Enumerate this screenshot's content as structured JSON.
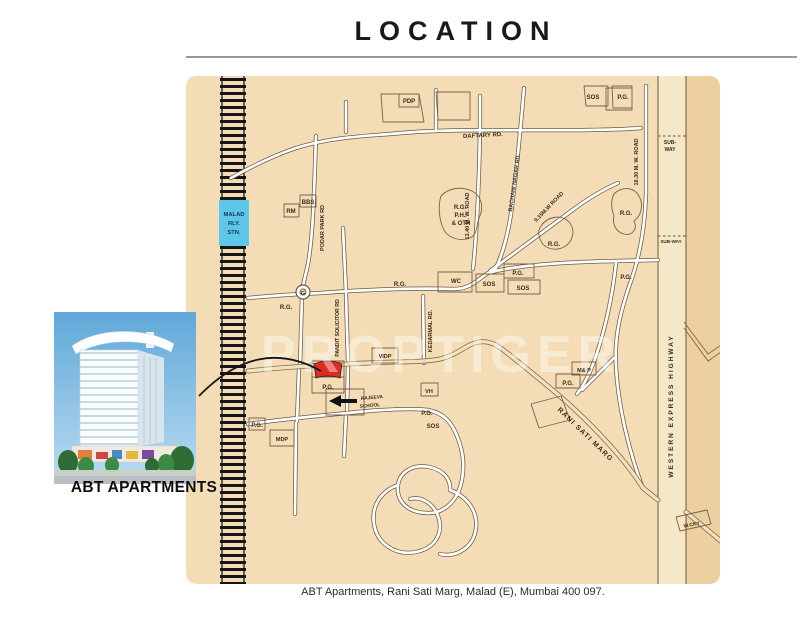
{
  "header": {
    "title": "LOCATION"
  },
  "footer": {
    "caption": "ABT Apartments, Rani Sati Marg, Malad (E), Mumbai 400 097."
  },
  "property": {
    "name": "ABT APARTMENTS"
  },
  "map": {
    "watermark": "PROPTIGER",
    "station": {
      "label": "MALAD RLY. STN."
    },
    "marker": {
      "label": "ABT Apartments site",
      "color": "#df2b22"
    },
    "colors": {
      "land": "#f4ddb6",
      "land_dark": "#ecd09f",
      "road_fill": "#ffffff",
      "road_casing": "#6b5942",
      "main_road_fill": "#efe3bd",
      "railway": "#151515",
      "station_bg": "#5ec7e9",
      "marker_red": "#df2b22"
    },
    "labels": [
      {
        "t": "PDP",
        "x": 223,
        "y": 27
      },
      {
        "t": "SOS",
        "x": 407,
        "y": 23
      },
      {
        "t": "P.G.",
        "x": 437,
        "y": 23
      },
      {
        "t": "DAFTARY RD.",
        "x": 297,
        "y": 61,
        "r": -3
      },
      {
        "t": "SUB-",
        "x": 484,
        "y": 68,
        "s": 5
      },
      {
        "t": "WAY",
        "x": 484,
        "y": 75,
        "s": 5
      },
      {
        "t": "MALAD",
        "x": 48,
        "y": 140,
        "s": 5.8,
        "f": "#14384e",
        "w": 700
      },
      {
        "t": "RLY.",
        "x": 48,
        "y": 149,
        "s": 5.8,
        "f": "#14384e",
        "w": 700
      },
      {
        "t": "STN.",
        "x": 48,
        "y": 158,
        "s": 5.8,
        "f": "#14384e",
        "w": 700
      },
      {
        "t": "RM",
        "x": 105,
        "y": 137
      },
      {
        "t": "BBS",
        "x": 122,
        "y": 128
      },
      {
        "t": "R.G.",
        "x": 274,
        "y": 133
      },
      {
        "t": "P.H.",
        "x": 274,
        "y": 141
      },
      {
        "t": "& OTH",
        "x": 275,
        "y": 149
      },
      {
        "t": "PODAR PARK RD",
        "x": 138,
        "y": 152,
        "r": -90,
        "s": 5.5
      },
      {
        "t": "13.40 M. W. ROAD",
        "x": 283,
        "y": 140,
        "r": -90,
        "s": 5.5
      },
      {
        "t": "BACHANI NAGAR RD.",
        "x": 330,
        "y": 107,
        "r": -82,
        "s": 5.5
      },
      {
        "t": "9.15M.W ROAD",
        "x": 364,
        "y": 132,
        "r": -46,
        "s": 5.5
      },
      {
        "t": "18.30 M. W. ROAD",
        "x": 452,
        "y": 86,
        "r": -90,
        "s": 5.5
      },
      {
        "t": "R.G.",
        "x": 440,
        "y": 139
      },
      {
        "t": "R.G.",
        "x": 368,
        "y": 170
      },
      {
        "t": "SUB-WAY",
        "x": 485,
        "y": 167,
        "s": 4.6
      },
      {
        "t": "WC",
        "x": 270,
        "y": 207
      },
      {
        "t": "SOS",
        "x": 303,
        "y": 210
      },
      {
        "t": "P.G.",
        "x": 332,
        "y": 199
      },
      {
        "t": "SOS",
        "x": 337,
        "y": 214
      },
      {
        "t": "R.G.",
        "x": 214,
        "y": 210
      },
      {
        "t": "P.G.",
        "x": 440,
        "y": 203
      },
      {
        "t": "G",
        "x": 117,
        "y": 219,
        "s": 5.5,
        "w": 700
      },
      {
        "t": "R.G.",
        "x": 100,
        "y": 233
      },
      {
        "t": "VIDP",
        "x": 199,
        "y": 282,
        "s": 5.5
      },
      {
        "t": "P.G.",
        "x": 142,
        "y": 313
      },
      {
        "t": "VH",
        "x": 243,
        "y": 317,
        "s": 5.5
      },
      {
        "t": "RAJEEVA",
        "x": 186,
        "y": 323,
        "s": 4.8,
        "r": -5
      },
      {
        "t": "SCHOOL",
        "x": 184,
        "y": 331,
        "s": 4.8,
        "r": -5
      },
      {
        "t": "P.G.",
        "x": 241,
        "y": 339
      },
      {
        "t": "SOS",
        "x": 247,
        "y": 352
      },
      {
        "t": "M& P",
        "x": 398,
        "y": 296,
        "s": 5.5
      },
      {
        "t": "P.G.",
        "x": 382,
        "y": 309
      },
      {
        "t": "RANI SATI MARG",
        "x": 398,
        "y": 360,
        "r": 44,
        "s": 7,
        "ls": 1.2,
        "w": 700
      },
      {
        "t": "WESTERN EXPRESS HIGHWAY",
        "x": 487,
        "y": 330,
        "r": -90,
        "s": 6.5,
        "ls": 2,
        "w": 700
      },
      {
        "t": "W.CKY",
        "x": 506,
        "y": 450,
        "r": -11,
        "s": 5
      },
      {
        "t": "P.G.",
        "x": 71,
        "y": 351
      },
      {
        "t": "MDP",
        "x": 96,
        "y": 365,
        "s": 5.5
      },
      {
        "t": "KEDARMAL RD.",
        "x": 246,
        "y": 255,
        "r": -90,
        "s": 5.5
      },
      {
        "t": "PANDIT SOLICITOR RD",
        "x": 153,
        "y": 252,
        "r": -90,
        "s": 5.2
      }
    ]
  }
}
